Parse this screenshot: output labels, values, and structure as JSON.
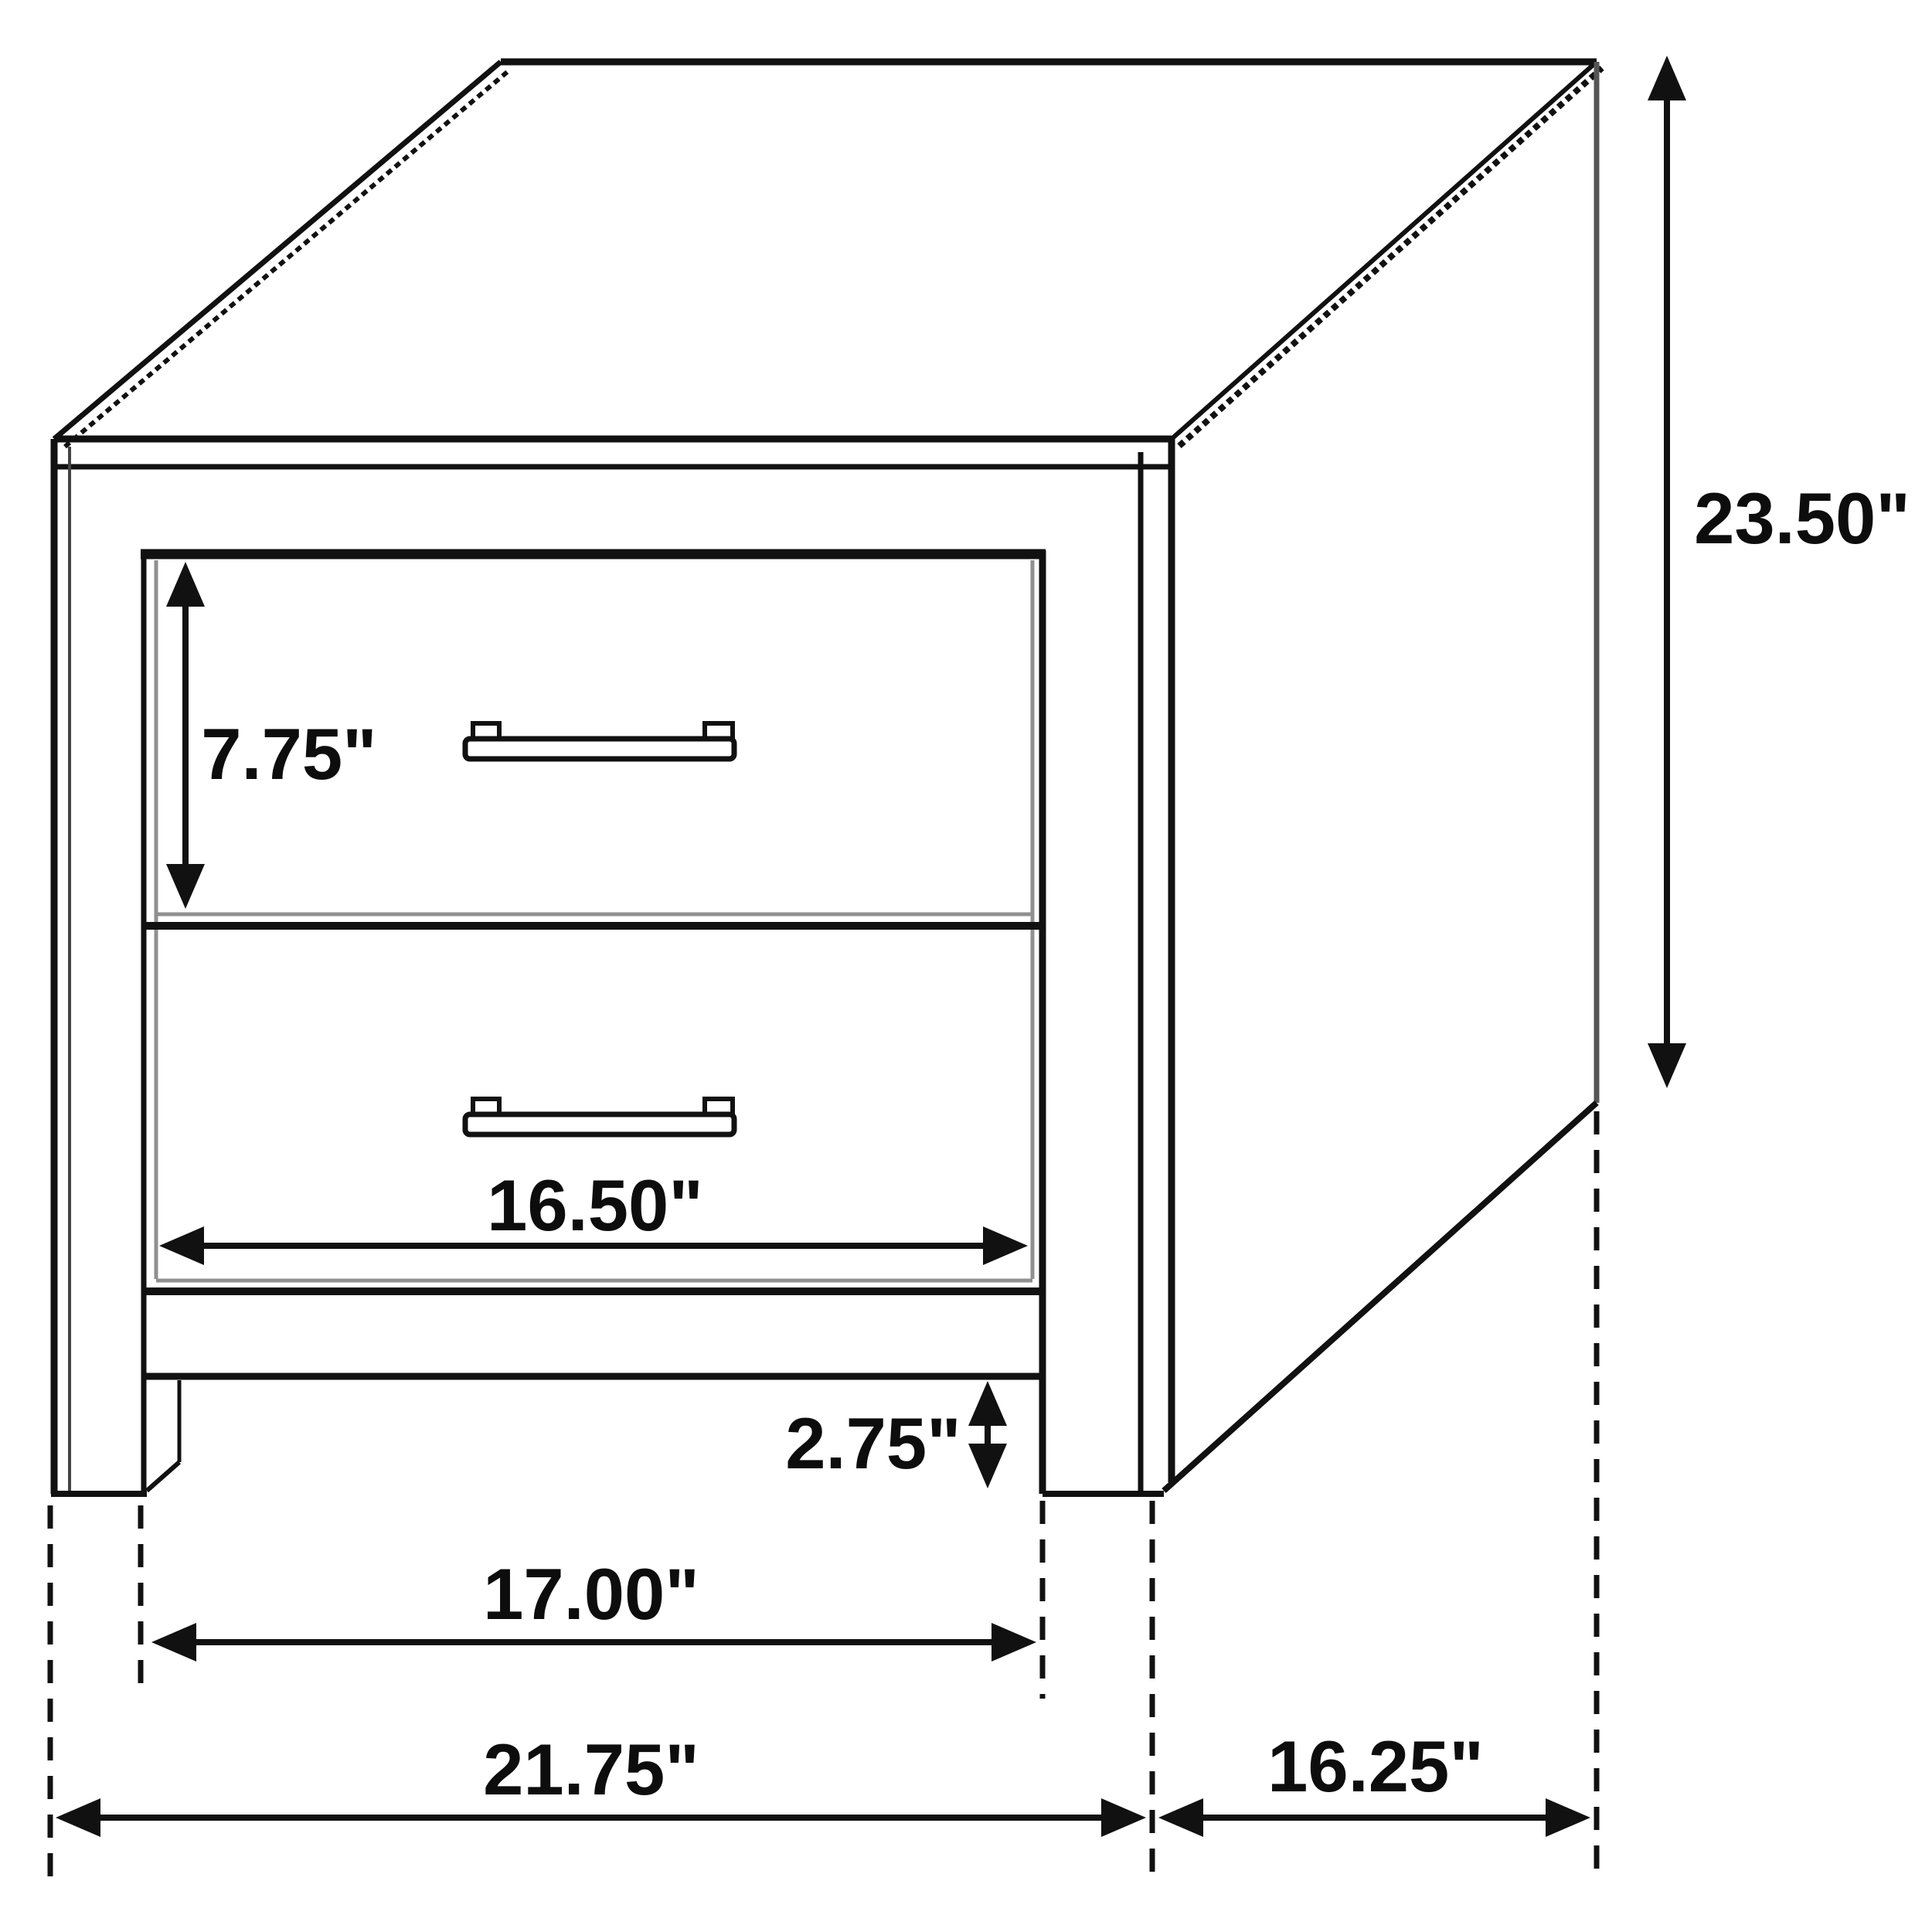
{
  "diagram": {
    "figure": "two-drawer-nightstand-line-drawing",
    "unit": "inches",
    "dimensions": {
      "drawer_face_height": "7.75\"",
      "overall_height": "23.50\"",
      "drawer_width": "16.50\"",
      "foot_height": "2.75\"",
      "width_between_legs": "17.00\"",
      "overall_width": "21.75\"",
      "depth": "16.25\""
    },
    "colors": {
      "line": "#111111",
      "shadow": "#909090",
      "background": "#ffffff"
    }
  }
}
